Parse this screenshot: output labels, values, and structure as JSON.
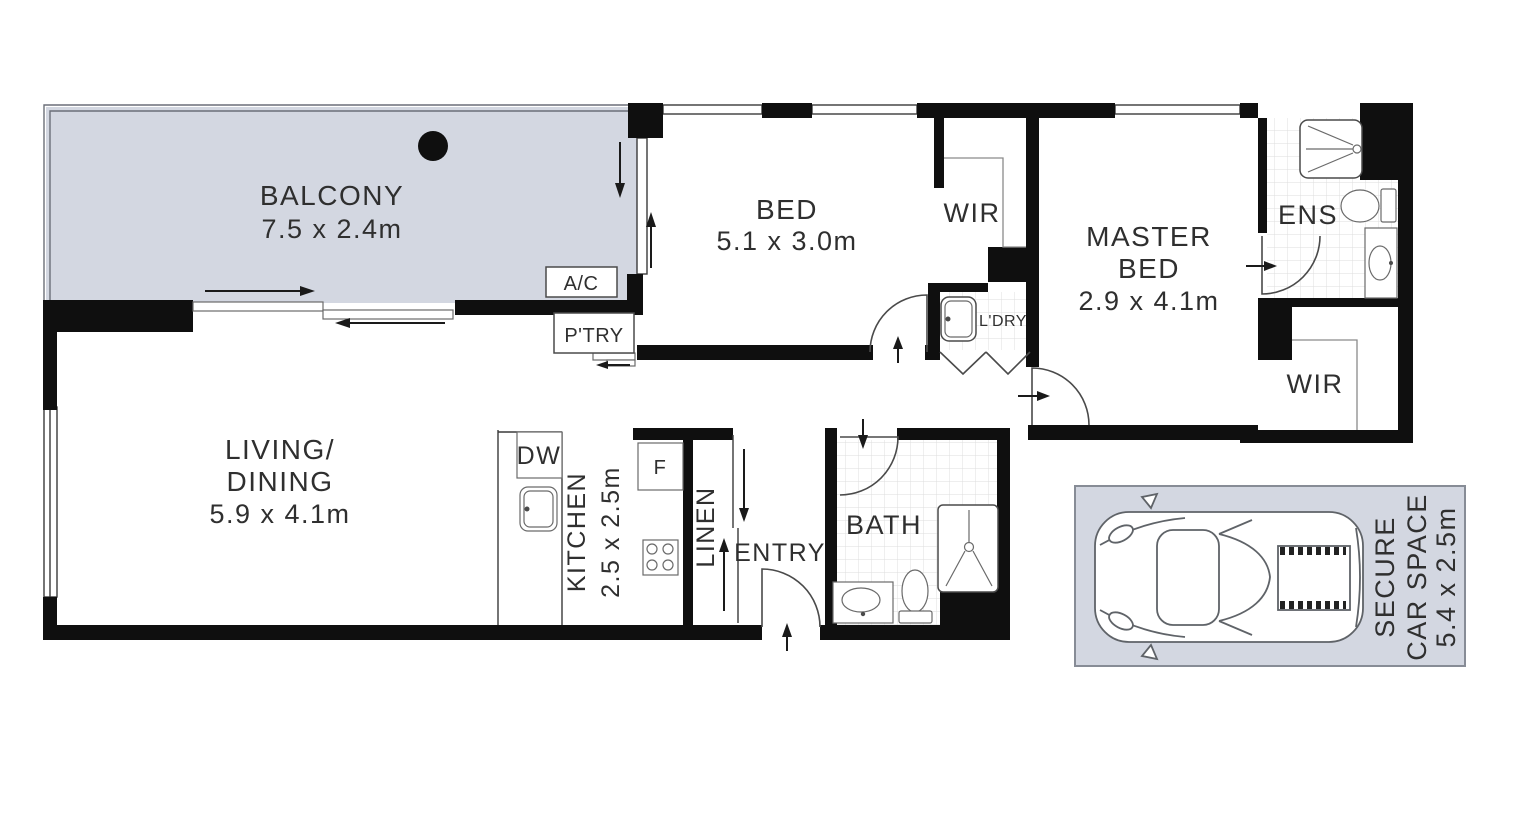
{
  "plan_title": "apartment-floor-plan",
  "rooms": {
    "balcony": {
      "name": "BALCONY",
      "dims": "7.5 x 2.4m"
    },
    "bed": {
      "name": "BED",
      "dims": "5.1 x 3.0m"
    },
    "wir": {
      "name": "WIR"
    },
    "master_bed": {
      "line1": "MASTER",
      "line2": "BED",
      "dims": "2.9 x 4.1m"
    },
    "ens": {
      "name": "ENS"
    },
    "wir2": {
      "name": "WIR"
    },
    "living_dining": {
      "line1": "LIVING/",
      "line2": "DINING",
      "dims": "5.9 x 4.1m"
    },
    "kitchen": {
      "name": "KITCHEN",
      "dims": "2.5 x 2.5m"
    },
    "linen": {
      "name": "LINEN"
    },
    "entry": {
      "name": "ENTRY"
    },
    "bath": {
      "name": "BATH"
    },
    "laundry": {
      "name": "L'DRY"
    },
    "pantry": {
      "name": "P'TRY"
    },
    "car_space": {
      "line1": "SECURE",
      "line2": "CAR SPACE",
      "dims": "5.4 x 2.5m"
    }
  },
  "fixtures": {
    "ac": "A/C",
    "dishwasher": "DW",
    "fridge": "F"
  },
  "colors": {
    "wall": "#0f0f0f",
    "outdoor_fill": "#d3d7e1",
    "tile_line": "#dcdcdc",
    "text": "#2f2f2f"
  }
}
